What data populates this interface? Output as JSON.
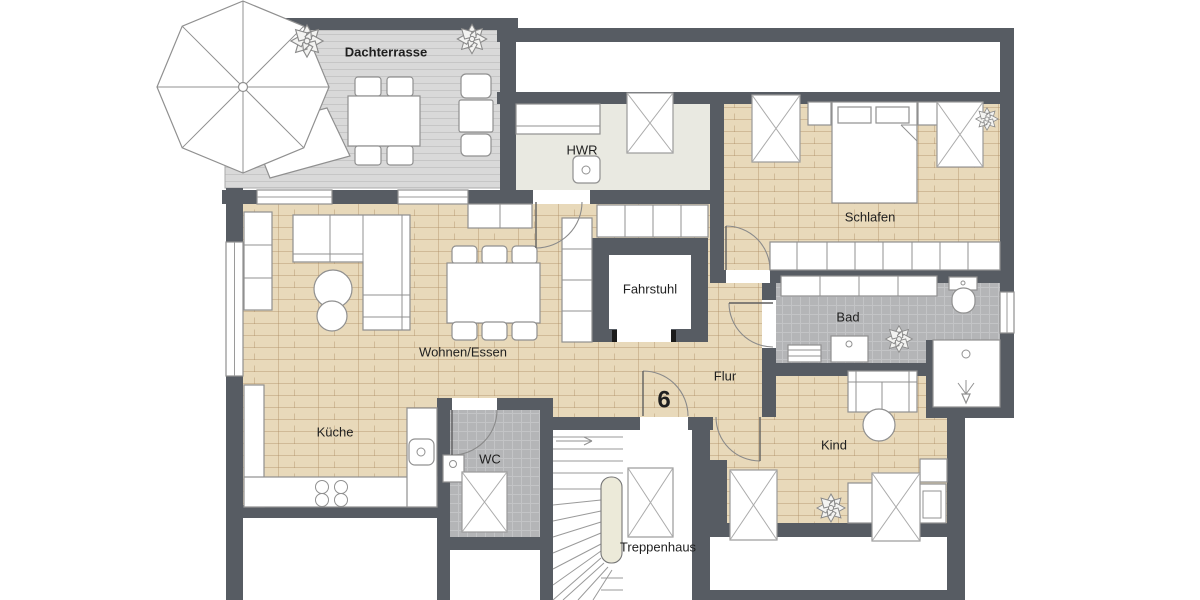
{
  "title": "Grundriss Wohnung 6 - Dachgeschoss",
  "labels": {
    "terrace": "Dachterrasse",
    "utility": "HWR",
    "bedroom": "Schlafen",
    "elevator": "Fahrstuhl",
    "living": "Wohnen/Essen",
    "hall": "Flur",
    "bath": "Bad",
    "child": "Kind",
    "kitchen": "Küche",
    "wc": "WC",
    "stairs": "Treppenhaus",
    "unit_number": "6"
  },
  "colors": {
    "wall": "#575c63",
    "wood": "#e8d9ba",
    "terrace": "#d9d9d9",
    "hwr": "#e9e9e1",
    "tile": "#b4b5b7",
    "rail": "#ecead9",
    "outline": "#909090",
    "text": "#1f1f1f",
    "leaf": "#f3f3f1"
  }
}
